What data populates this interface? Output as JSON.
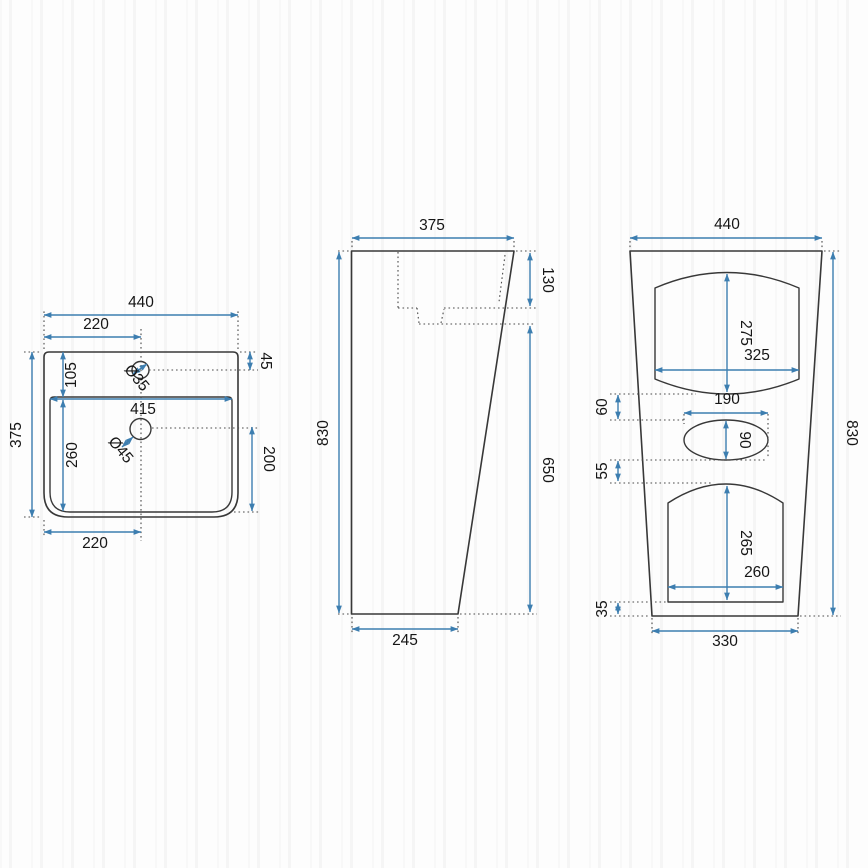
{
  "drawing": {
    "kind": "technical-dimension-drawing",
    "subject": "freestanding pedestal washbasin, three orthographic views",
    "units": "mm",
    "colors": {
      "dimension_line": "#3d7eb0",
      "outline": "#383838",
      "label": "#161616"
    },
    "views": {
      "top": {
        "label": "top view (basin plan)",
        "dims": {
          "width_total": "440",
          "width_to_center_top": "220",
          "faucet_from_back": "45",
          "basin_from_back": "105",
          "depth_total": "375",
          "basin_width": "415",
          "basin_depth": "260",
          "drain_to_front": "200",
          "width_to_center_bottom": "220",
          "faucet_hole_diameter": "Ø35",
          "drain_hole_diameter": "Ø45"
        }
      },
      "side": {
        "label": "side view",
        "dims": {
          "depth_top": "375",
          "basin_inner_depth": "130",
          "height_total": "830",
          "front_height": "650",
          "depth_bottom": "245"
        }
      },
      "front": {
        "label": "front view",
        "dims": {
          "width_top": "440",
          "recess_upper_height": "275",
          "recess_upper_width": "325",
          "gap_recess_to_oval": "60",
          "oval_width": "190",
          "oval_height": "90",
          "gap_oval_to_recess": "55",
          "recess_lower_height": "265",
          "recess_lower_width": "260",
          "base_height": "35",
          "width_bottom": "330",
          "height_total": "830"
        }
      }
    }
  }
}
